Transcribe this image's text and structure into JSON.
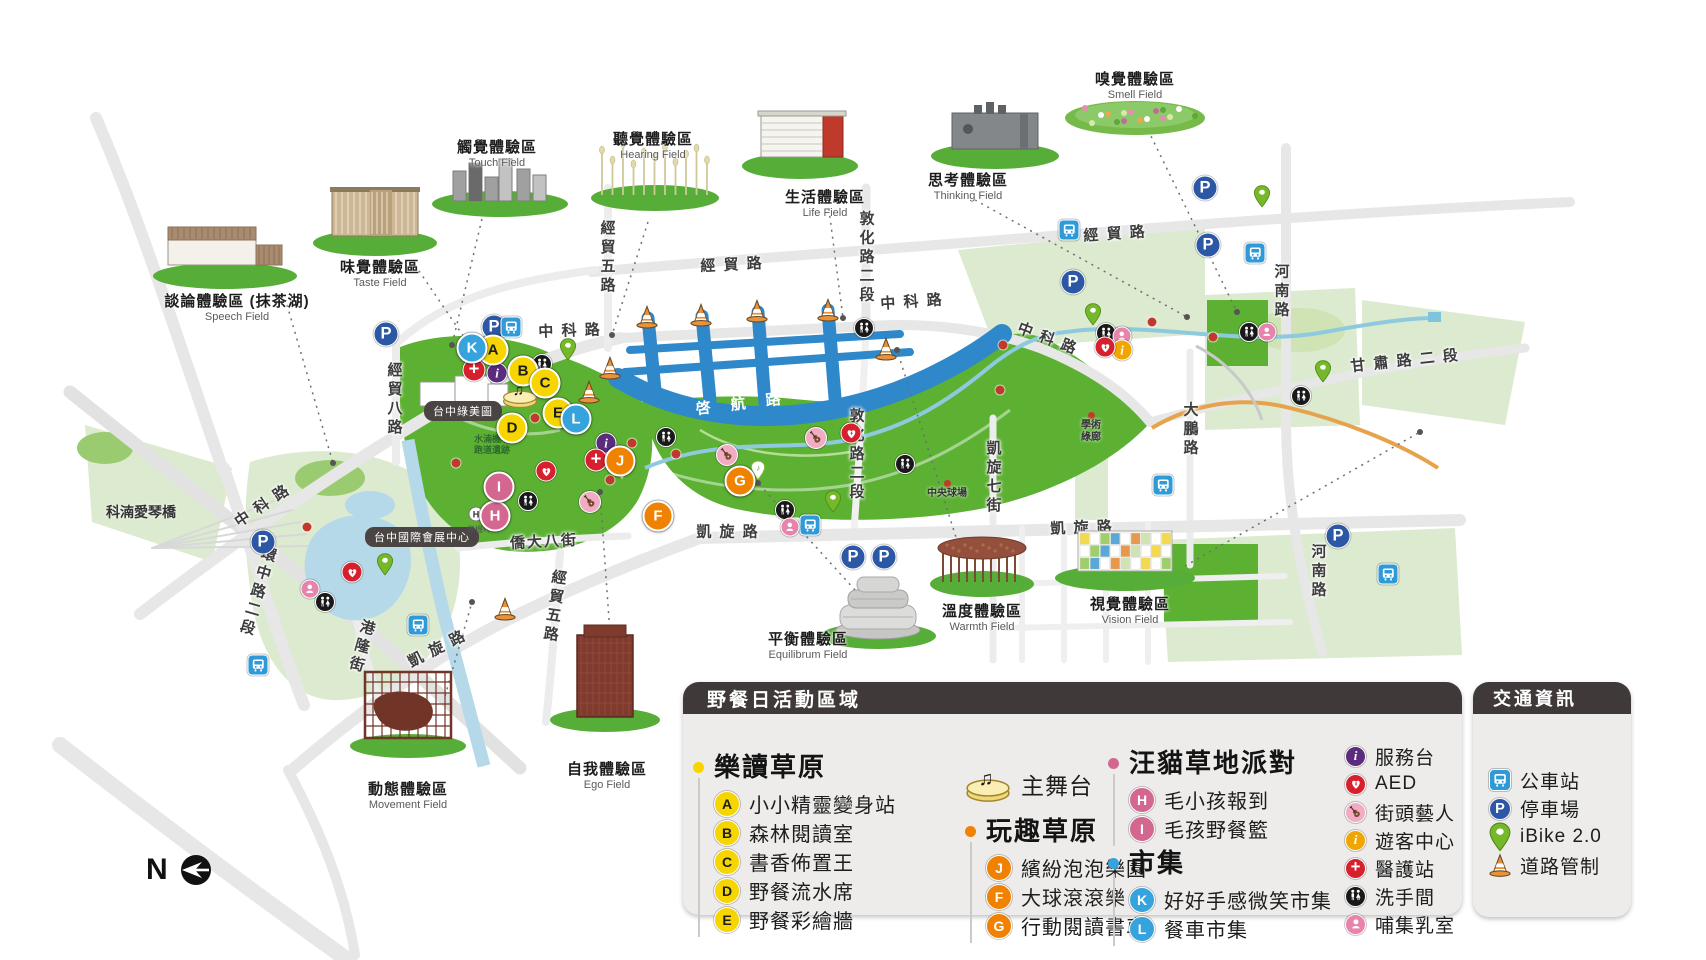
{
  "colors": {
    "park_bright": "#5cb133",
    "park_pale": "#dcead0",
    "water": "#b5d9e8",
    "canal_blue": "#2f88c9",
    "road_gray": "#e7e7e7",
    "legend_bg": "#edecea",
    "legend_header": "#3f3a39",
    "yellow": "#f6d500",
    "orange": "#ef8200",
    "pink": "#d46790",
    "blue": "#36a3dd",
    "info_purple": "#5b2c7e",
    "info_yellow": "#f0a500",
    "medical_red": "#d6202e",
    "nursing_pink": "#e883ab",
    "guitar_pink": "#f2abc4",
    "bus_blue": "#2e9bd8",
    "parking_blue": "#2b57a5",
    "ibike_green": "#76b82a",
    "cone_orange": "#e8923a"
  },
  "legend": {
    "title": "野餐日活動區域",
    "stage": {
      "icon": "stage",
      "label": "主舞台"
    },
    "sections": [
      {
        "id": "happy-read",
        "title": "樂讀草原",
        "color": "#f6d500",
        "style": "yellow",
        "items": [
          {
            "letter": "A",
            "label": "小小精靈變身站"
          },
          {
            "letter": "B",
            "label": "森林閱讀室"
          },
          {
            "letter": "C",
            "label": "書香佈置王"
          },
          {
            "letter": "D",
            "label": "野餐流水席"
          },
          {
            "letter": "E",
            "label": "野餐彩繪牆"
          }
        ]
      },
      {
        "id": "fun-grass",
        "title": "玩趣草原",
        "color": "#ef8200",
        "style": "orange",
        "items": [
          {
            "letter": "J",
            "label": "繽紛泡泡樂園"
          },
          {
            "letter": "F",
            "label": "大球滾滾樂"
          },
          {
            "letter": "G",
            "label": "行動閱讀書車"
          }
        ]
      },
      {
        "id": "pet-party",
        "title": "汪貓草地派對",
        "color": "#d46790",
        "style": "pink",
        "items": [
          {
            "letter": "H",
            "label": "毛小孩報到"
          },
          {
            "letter": "I",
            "label": "毛孩野餐籃"
          }
        ]
      },
      {
        "id": "market",
        "title": "市集",
        "color": "#36a3dd",
        "style": "blue",
        "items": [
          {
            "letter": "K",
            "label": "好好手感微笑市集"
          },
          {
            "letter": "L",
            "label": "餐車市集"
          }
        ]
      }
    ],
    "facilities": [
      {
        "icon": "info-purple",
        "label": "服務台"
      },
      {
        "icon": "aed",
        "label": "AED"
      },
      {
        "icon": "guitar",
        "label": "街頭藝人"
      },
      {
        "icon": "info-yellow",
        "label": "遊客中心"
      },
      {
        "icon": "medical",
        "label": "醫護站"
      },
      {
        "icon": "restroom",
        "label": "洗手間"
      },
      {
        "icon": "nursing",
        "label": "哺集乳室"
      }
    ]
  },
  "transport": {
    "title": "交通資訊",
    "items": [
      {
        "icon": "bus",
        "label": "公車站"
      },
      {
        "icon": "parking",
        "label": "停車場"
      },
      {
        "icon": "ibike",
        "label": "iBike 2.0"
      },
      {
        "icon": "cone",
        "label": "道路管制"
      }
    ]
  },
  "compass": {
    "label": "N"
  },
  "map": {
    "canal_label": "啓 航 路",
    "fields": [
      {
        "id": "speech",
        "name": "談論體驗區 (抹茶湖)",
        "name_en": "Speech Field",
        "type": "speech",
        "x": 225,
        "y": 268,
        "label_x": 237,
        "label_y": 300
      },
      {
        "id": "taste",
        "name": "味覺體驗區",
        "name_en": "Taste Field",
        "type": "taste",
        "x": 375,
        "y": 235,
        "label_x": 380,
        "label_y": 266
      },
      {
        "id": "touch",
        "name": "觸覺體驗區",
        "name_en": "Touch Field",
        "type": "touch",
        "x": 500,
        "y": 196,
        "label_x": 497,
        "label_y": 146
      },
      {
        "id": "hearing",
        "name": "聽覺體驗區",
        "name_en": "Hearing Field",
        "type": "hearing",
        "x": 655,
        "y": 190,
        "label_x": 653,
        "label_y": 138
      },
      {
        "id": "life",
        "name": "生活體驗區",
        "name_en": "Life Field",
        "type": "life",
        "x": 800,
        "y": 158,
        "label_x": 825,
        "label_y": 196
      },
      {
        "id": "thinking",
        "name": "思考體驗區",
        "name_en": "Thinking Field",
        "type": "thinking",
        "x": 995,
        "y": 148,
        "label_x": 968,
        "label_y": 179
      },
      {
        "id": "smell",
        "name": "嗅覺體驗區",
        "name_en": "Smell Field",
        "type": "smell",
        "x": 1135,
        "y": 115,
        "label_x": 1135,
        "label_y": 78
      },
      {
        "id": "vision",
        "name": "視覺體驗區",
        "name_en": "Vision Field",
        "type": "vision",
        "x": 1125,
        "y": 570,
        "label_x": 1130,
        "label_y": 603
      },
      {
        "id": "warmth",
        "name": "溫度體驗區",
        "name_en": "Warmth Field",
        "type": "warmth",
        "x": 982,
        "y": 576,
        "label_x": 982,
        "label_y": 610
      },
      {
        "id": "equilibrium",
        "name": "平衡體驗區",
        "name_en": "Equilibrum Field",
        "type": "equilibrium",
        "x": 878,
        "y": 628,
        "label_x": 808,
        "label_y": 638
      },
      {
        "id": "ego",
        "name": "自我體驗區",
        "name_en": "Ego Field",
        "type": "ego",
        "x": 605,
        "y": 712,
        "label_x": 607,
        "label_y": 768
      },
      {
        "id": "movement",
        "name": "動態體驗區",
        "name_en": "Movement Field",
        "type": "movement",
        "x": 408,
        "y": 738,
        "label_x": 408,
        "label_y": 788
      }
    ],
    "roads": [
      {
        "text": "經 貿 路",
        "x": 732,
        "y": 264,
        "rot": -3
      },
      {
        "text": "經 貿 路",
        "x": 1115,
        "y": 233,
        "rot": -4
      },
      {
        "text": "中 科 路",
        "x": 570,
        "y": 330,
        "rot": -2
      },
      {
        "text": "中 科 路",
        "x": 912,
        "y": 301,
        "rot": -4
      },
      {
        "text": "中 科 路",
        "x": 1048,
        "y": 338,
        "rot": 21
      },
      {
        "text": "中 科 路",
        "x": 262,
        "y": 505,
        "rot": -34
      },
      {
        "text": "敦化路二段",
        "x": 866,
        "y": 258,
        "v": true
      },
      {
        "text": "敦化路二段",
        "x": 856,
        "y": 455,
        "v": true
      },
      {
        "text": "河南路",
        "x": 1281,
        "y": 292,
        "v": true
      },
      {
        "text": "河南路",
        "x": 1318,
        "y": 572,
        "v": true
      },
      {
        "text": "甘 肅 路 二 段",
        "x": 1405,
        "y": 360,
        "rot": -6
      },
      {
        "text": "大鵬路",
        "x": 1190,
        "y": 430,
        "v": true
      },
      {
        "text": "凱旋七街",
        "x": 993,
        "y": 478,
        "v": true
      },
      {
        "text": "凱 旋 路",
        "x": 728,
        "y": 531,
        "rot": 0
      },
      {
        "text": "凱 旋 路",
        "x": 1082,
        "y": 527,
        "rot": -2
      },
      {
        "text": "凱 旋 路",
        "x": 437,
        "y": 648,
        "rot": -27
      },
      {
        "text": "經貿五路",
        "x": 607,
        "y": 258,
        "v": true
      },
      {
        "text": "經貿五路",
        "x": 554,
        "y": 607,
        "v": true,
        "rot": 8
      },
      {
        "text": "經貿八路",
        "x": 394,
        "y": 400,
        "v": true
      },
      {
        "text": "環中路二段",
        "x": 257,
        "y": 592,
        "v": true,
        "rot": 16
      },
      {
        "text": "港隆街",
        "x": 361,
        "y": 647,
        "v": true,
        "rot": 16
      },
      {
        "text": "僑大八街",
        "x": 544,
        "y": 541,
        "rot": -3
      }
    ],
    "places": [
      {
        "type": "pill",
        "text": "台中綠美圖",
        "x": 463,
        "y": 411
      },
      {
        "type": "pill",
        "text": "台中國際會展中心",
        "x": 422,
        "y": 537
      },
      {
        "type": "plain",
        "text": "科湳愛琴橋",
        "x": 141,
        "y": 512
      },
      {
        "type": "dot",
        "text": "中央球場",
        "x": 947,
        "y": 480
      },
      {
        "type": "dot",
        "text": "學術綠廊",
        "x": 1091,
        "y": 412,
        "two": true
      },
      {
        "type": "green",
        "text": "水湳機場跑道遺跡",
        "x": 492,
        "y": 434,
        "two": true
      },
      {
        "type": "tiny",
        "text": "停機坪",
        "x": 479,
        "y": 524
      }
    ],
    "spots": [
      {
        "letter": "A",
        "style": "yellow",
        "x": 493,
        "y": 350
      },
      {
        "letter": "B",
        "style": "yellow",
        "x": 523,
        "y": 371
      },
      {
        "letter": "C",
        "style": "yellow",
        "x": 545,
        "y": 383
      },
      {
        "letter": "D",
        "style": "yellow",
        "x": 512,
        "y": 428
      },
      {
        "letter": "E",
        "style": "yellow",
        "x": 558,
        "y": 413
      },
      {
        "letter": "J",
        "style": "orange",
        "x": 620,
        "y": 461
      },
      {
        "letter": "F",
        "style": "orange",
        "x": 658,
        "y": 516
      },
      {
        "letter": "G",
        "style": "orange",
        "x": 740,
        "y": 481
      },
      {
        "letter": "H",
        "style": "pink",
        "x": 495,
        "y": 516
      },
      {
        "letter": "I",
        "style": "pink",
        "x": 499,
        "y": 487
      },
      {
        "letter": "K",
        "style": "blue",
        "x": 472,
        "y": 348
      },
      {
        "letter": "L",
        "style": "blue",
        "x": 576,
        "y": 419
      }
    ],
    "markers": [
      {
        "type": "stage",
        "x": 520,
        "y": 394
      },
      {
        "type": "parking",
        "x": 494,
        "y": 327
      },
      {
        "type": "parking",
        "x": 386,
        "y": 334
      },
      {
        "type": "parking",
        "x": 263,
        "y": 542
      },
      {
        "type": "parking",
        "x": 1205,
        "y": 188
      },
      {
        "type": "parking",
        "x": 1208,
        "y": 245
      },
      {
        "type": "parking",
        "x": 1073,
        "y": 282
      },
      {
        "type": "parking",
        "x": 853,
        "y": 557
      },
      {
        "type": "parking",
        "x": 884,
        "y": 557
      },
      {
        "type": "parking",
        "x": 1338,
        "y": 536
      },
      {
        "type": "bus",
        "x": 511,
        "y": 327
      },
      {
        "type": "bus",
        "x": 1069,
        "y": 230
      },
      {
        "type": "bus",
        "x": 1255,
        "y": 253
      },
      {
        "type": "bus",
        "x": 418,
        "y": 625
      },
      {
        "type": "bus",
        "x": 258,
        "y": 665
      },
      {
        "type": "bus",
        "x": 810,
        "y": 525
      },
      {
        "type": "bus",
        "x": 1163,
        "y": 485
      },
      {
        "type": "bus",
        "x": 1388,
        "y": 574
      },
      {
        "type": "ibike",
        "x": 568,
        "y": 358
      },
      {
        "type": "ibike",
        "x": 833,
        "y": 510
      },
      {
        "type": "ibike",
        "x": 1093,
        "y": 323
      },
      {
        "type": "ibike",
        "x": 1262,
        "y": 205
      },
      {
        "type": "ibike",
        "x": 1323,
        "y": 380
      },
      {
        "type": "ibike",
        "x": 385,
        "y": 573
      },
      {
        "type": "restroom",
        "x": 542,
        "y": 364
      },
      {
        "type": "restroom",
        "x": 666,
        "y": 437
      },
      {
        "type": "restroom",
        "x": 864,
        "y": 328
      },
      {
        "type": "restroom",
        "x": 905,
        "y": 464
      },
      {
        "type": "restroom",
        "x": 785,
        "y": 510
      },
      {
        "type": "restroom",
        "x": 1106,
        "y": 333
      },
      {
        "type": "restroom",
        "x": 1249,
        "y": 332
      },
      {
        "type": "restroom",
        "x": 1301,
        "y": 396
      },
      {
        "type": "restroom",
        "x": 325,
        "y": 602
      },
      {
        "type": "restroom",
        "x": 528,
        "y": 501
      },
      {
        "type": "nursing",
        "x": 1122,
        "y": 336
      },
      {
        "type": "nursing",
        "x": 1267,
        "y": 332
      },
      {
        "type": "nursing",
        "x": 790,
        "y": 527
      },
      {
        "type": "nursing",
        "x": 310,
        "y": 589
      },
      {
        "type": "info-purple",
        "x": 497,
        "y": 373
      },
      {
        "type": "info-purple",
        "x": 606,
        "y": 443
      },
      {
        "type": "medical",
        "x": 474,
        "y": 370
      },
      {
        "type": "medical",
        "x": 596,
        "y": 460
      },
      {
        "type": "info-yellow",
        "x": 1122,
        "y": 350
      },
      {
        "type": "aed",
        "x": 851,
        "y": 433
      },
      {
        "type": "aed",
        "x": 1105,
        "y": 347
      },
      {
        "type": "aed",
        "x": 352,
        "y": 572
      },
      {
        "type": "aed",
        "x": 546,
        "y": 471
      },
      {
        "type": "guitar",
        "x": 727,
        "y": 455
      },
      {
        "type": "guitar",
        "x": 816,
        "y": 438
      },
      {
        "type": "guitar",
        "x": 590,
        "y": 502
      },
      {
        "type": "music-pin",
        "x": 622,
        "y": 478
      },
      {
        "type": "music-pin",
        "x": 758,
        "y": 478
      },
      {
        "type": "helipad",
        "x": 476,
        "y": 514
      },
      {
        "type": "cone",
        "x": 647,
        "y": 317
      },
      {
        "type": "cone",
        "x": 701,
        "y": 315
      },
      {
        "type": "cone",
        "x": 757,
        "y": 311
      },
      {
        "type": "cone",
        "x": 828,
        "y": 310
      },
      {
        "type": "cone",
        "x": 610,
        "y": 368
      },
      {
        "type": "cone",
        "x": 589,
        "y": 392
      },
      {
        "type": "cone",
        "x": 886,
        "y": 349
      },
      {
        "type": "cone",
        "x": 505,
        "y": 609
      }
    ],
    "red_dots": [
      {
        "x": 535,
        "y": 418
      },
      {
        "x": 632,
        "y": 443
      },
      {
        "x": 610,
        "y": 480
      },
      {
        "x": 676,
        "y": 454
      },
      {
        "x": 1003,
        "y": 345
      },
      {
        "x": 1000,
        "y": 390
      },
      {
        "x": 1152,
        "y": 322
      },
      {
        "x": 1213,
        "y": 337
      },
      {
        "x": 307,
        "y": 527
      },
      {
        "x": 456,
        "y": 463
      }
    ]
  }
}
